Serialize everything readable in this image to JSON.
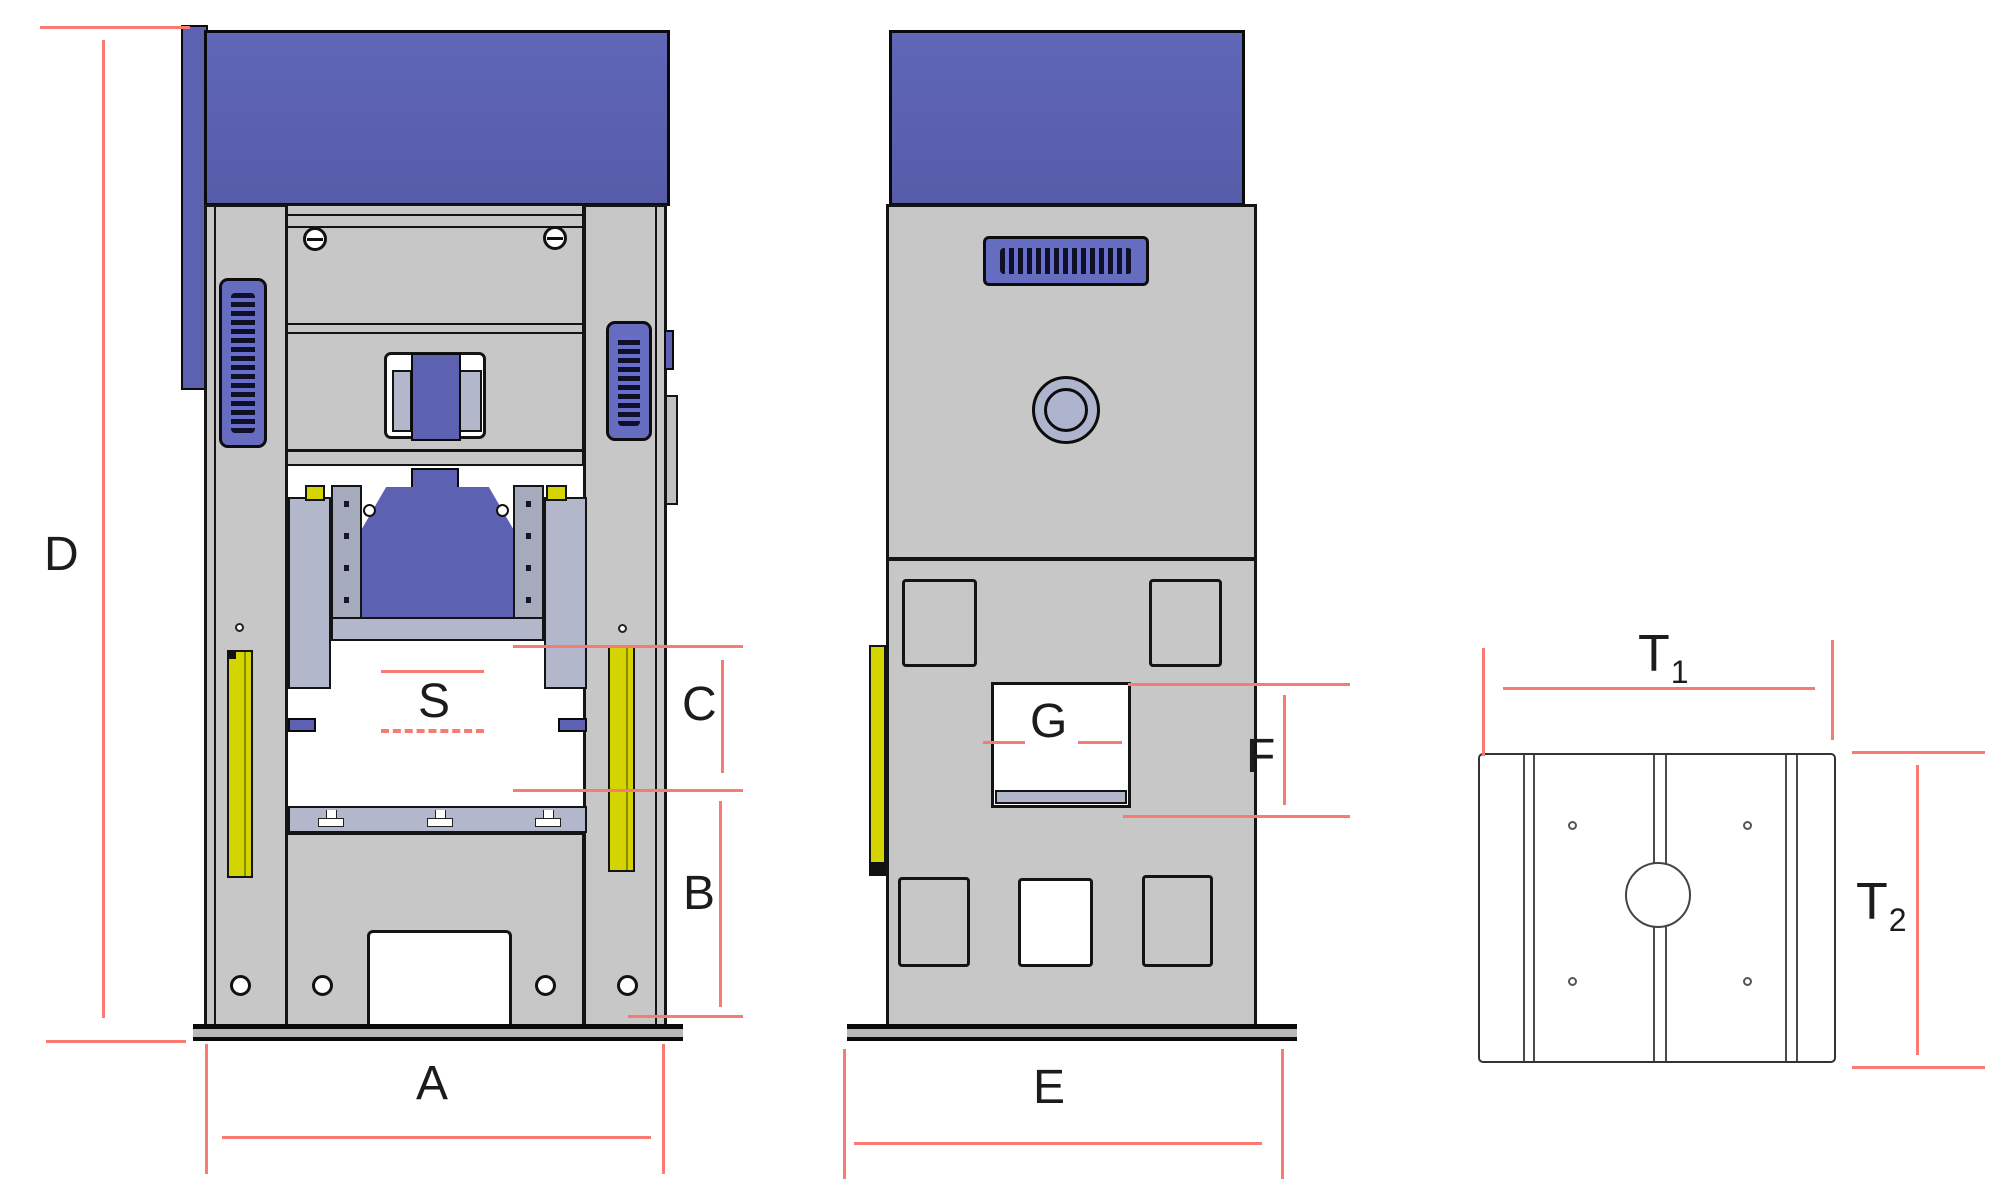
{
  "drawing": {
    "type": "technical-drawing",
    "subject": "Hydraulic press three-view dimensional drawing",
    "colors": {
      "dimension_line_red": "#f87a72",
      "machine_blue": "#5c61b2",
      "frame_gray": "#c7c7c7",
      "steel_blue_gray": "#b3b7cb",
      "safety_yellow": "#d4d400"
    },
    "front_view": {
      "height_dim": "D",
      "base_width_dim": "A",
      "stroke_dim": "S",
      "daylight_dim": "C",
      "table_height_dim": "B"
    },
    "side_view": {
      "window_dim": "G",
      "window_height_dim": "F",
      "base_depth_dim": "E"
    },
    "top_view": {
      "t1": {
        "base": "T",
        "sub": "1"
      },
      "t2": {
        "base": "T",
        "sub": "2"
      }
    }
  }
}
